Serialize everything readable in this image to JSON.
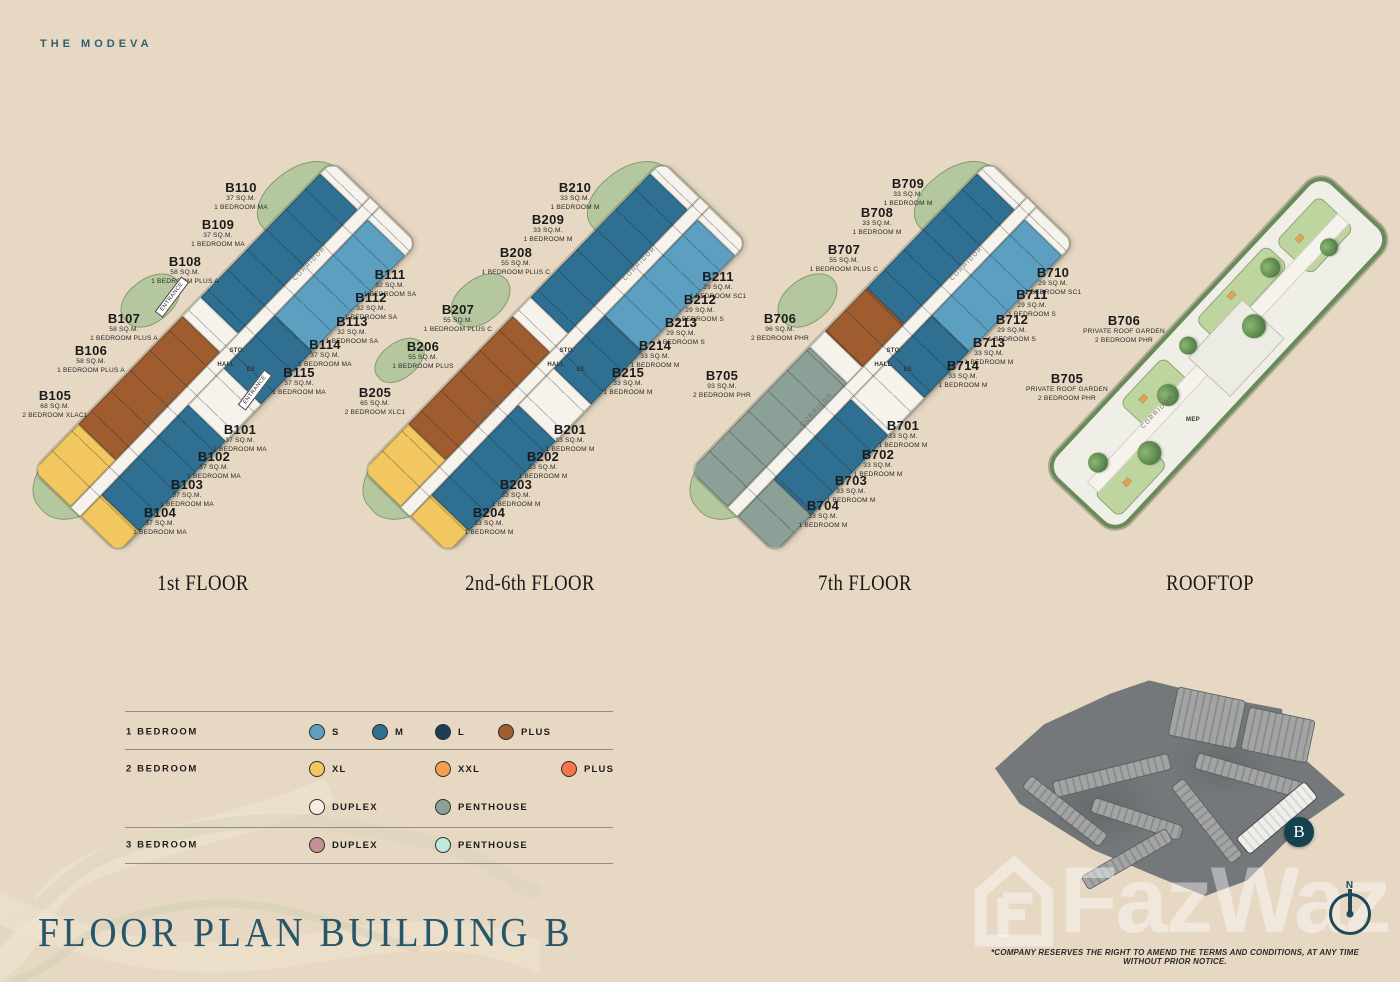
{
  "brand": "THE MODEVA",
  "page_title": "FLOOR PLAN BUILDING B",
  "disclaimer": "*COMPANY RESERVES THE RIGHT TO AMEND THE TERMS AND CONDITIONS, AT ANY TIME WITHOUT PRIOR NOTICE.",
  "watermark": "FazWaz",
  "compass_label": "N",
  "site_map": {
    "building_marker": "B"
  },
  "plan_labels": {
    "hall": "HALL",
    "storage": "STO.",
    "lift": "EE",
    "entrance": "ENTRANCE",
    "corridor": "CORRIDOR",
    "mep": "MEP"
  },
  "colors": {
    "background": "#E6D8C3",
    "accent_teal": "#26566A",
    "bed1_s": "#5D9FC1",
    "bed1_m": "#2F7092",
    "bed1_l": "#1F3D52",
    "bed1_plus": "#9E5C2F",
    "bed2_xl": "#F2C75F",
    "bed2_xxl": "#F2A050",
    "bed2_plus": "#F4764A",
    "bed2_duplex": "#F9EDE3",
    "bed2_penthouse": "#8BA198",
    "bed3_duplex": "#C48F96",
    "bed3_penthouse": "#BFE9DB",
    "landscape_green": "#B5C79E"
  },
  "floors": [
    {
      "name": "1st FLOOR",
      "units": [
        {
          "id": "B110",
          "area": "37 SQ.M.",
          "type": "1 BEDROOM MA"
        },
        {
          "id": "B109",
          "area": "37 SQ.M.",
          "type": "1 BEDROOM MA"
        },
        {
          "id": "B108",
          "area": "58 SQ.M.",
          "type": "1 BEDROOM PLUS A"
        },
        {
          "id": "B107",
          "area": "58 SQ.M.",
          "type": "1 BEDROOM PLUS A"
        },
        {
          "id": "B106",
          "area": "58 SQ.M.",
          "type": "1 BEDROOM PLUS A"
        },
        {
          "id": "B105",
          "area": "68 SQ.M.",
          "type": "2 BEDROOM XLAC1"
        },
        {
          "id": "B111",
          "area": "32 SQ.M.",
          "type": "1 BEDROOM SA"
        },
        {
          "id": "B112",
          "area": "32 SQ.M.",
          "type": "1 BEDROOM SA"
        },
        {
          "id": "B113",
          "area": "32 SQ.M.",
          "type": "1 BEDROOM SA"
        },
        {
          "id": "B114",
          "area": "37 SQ.M.",
          "type": "1 BEDROOM MA"
        },
        {
          "id": "B115",
          "area": "37 SQ.M.",
          "type": "1 BEDROOM MA"
        },
        {
          "id": "B101",
          "area": "37 SQ.M.",
          "type": "1 BEDROOM MA"
        },
        {
          "id": "B102",
          "area": "37 SQ.M.",
          "type": "1 BEDROOM MA"
        },
        {
          "id": "B103",
          "area": "37 SQ.M.",
          "type": "1 BEDROOM MA"
        },
        {
          "id": "B104",
          "area": "37 SQ.M.",
          "type": "1 BEDROOM MA"
        }
      ]
    },
    {
      "name": "2nd-6th FLOOR",
      "units": [
        {
          "id": "B210",
          "area": "33 SQ.M.",
          "type": "1 BEDROOM M"
        },
        {
          "id": "B209",
          "area": "33 SQ.M.",
          "type": "1 BEDROOM M"
        },
        {
          "id": "B208",
          "area": "55 SQ.M.",
          "type": "1 BEDROOM PLUS C"
        },
        {
          "id": "B207",
          "area": "55 SQ.M.",
          "type": "1 BEDROOM PLUS C"
        },
        {
          "id": "B206",
          "area": "55 SQ.M.",
          "type": "1 BEDROOM PLUS"
        },
        {
          "id": "B205",
          "area": "65 SQ.M.",
          "type": "2 BEDROOM XLC1"
        },
        {
          "id": "B211",
          "area": "29 SQ.M.",
          "type": "1 BEDROOM SC1"
        },
        {
          "id": "B212",
          "area": "29 SQ.M.",
          "type": "1 BEDROOM S"
        },
        {
          "id": "B213",
          "area": "29 SQ.M.",
          "type": "1 BEDROOM S"
        },
        {
          "id": "B214",
          "area": "33 SQ.M.",
          "type": "1 BEDROOM M"
        },
        {
          "id": "B215",
          "area": "33 SQ.M.",
          "type": "1 BEDROOM M"
        },
        {
          "id": "B201",
          "area": "33 SQ.M.",
          "type": "1 BEDROOM M"
        },
        {
          "id": "B202",
          "area": "33 SQ.M.",
          "type": "1 BEDROOM M"
        },
        {
          "id": "B203",
          "area": "33 SQ.M.",
          "type": "1 BEDROOM M"
        },
        {
          "id": "B204",
          "area": "33 SQ.M.",
          "type": "1 BEDROOM M"
        }
      ]
    },
    {
      "name": "7th FLOOR",
      "units": [
        {
          "id": "B709",
          "area": "33 SQ.M.",
          "type": "1 BEDROOM M"
        },
        {
          "id": "B708",
          "area": "33 SQ.M.",
          "type": "1 BEDROOM M"
        },
        {
          "id": "B707",
          "area": "55 SQ.M.",
          "type": "1 BEDROOM PLUS C"
        },
        {
          "id": "B706",
          "area": "96 SQ.M.",
          "type": "2 BEDROOM PHR"
        },
        {
          "id": "B705",
          "area": "93 SQ.M.",
          "type": "2 BEDROOM PHR"
        },
        {
          "id": "B710",
          "area": "29 SQ.M.",
          "type": "1 BEDROOM SC1"
        },
        {
          "id": "B711",
          "area": "29 SQ.M.",
          "type": "1 BEDROOM S"
        },
        {
          "id": "B712",
          "area": "29 SQ.M.",
          "type": "1 BEDROOM S"
        },
        {
          "id": "B713",
          "area": "33 SQ.M.",
          "type": "1 BEDROOM M"
        },
        {
          "id": "B714",
          "area": "33 SQ.M.",
          "type": "1 BEDROOM M"
        },
        {
          "id": "B701",
          "area": "33 SQ.M.",
          "type": "1 BEDROOM M"
        },
        {
          "id": "B702",
          "area": "33 SQ.M.",
          "type": "1 BEDROOM M"
        },
        {
          "id": "B703",
          "area": "33 SQ.M.",
          "type": "1 BEDROOM M"
        },
        {
          "id": "B704",
          "area": "33 SQ.M.",
          "type": "1 BEDROOM M"
        }
      ]
    },
    {
      "name": "ROOFTOP",
      "units": [
        {
          "id": "B706",
          "area": "PRIVATE ROOF GARDEN",
          "type": "2 BEDROOM PHR"
        },
        {
          "id": "B705",
          "area": "PRIVATE ROOF GARDEN",
          "type": "2 BEDROOM PHR"
        }
      ]
    }
  ],
  "legend": {
    "rows": [
      {
        "label": "1 BEDROOM",
        "items": [
          {
            "label": "S",
            "color": "#5D9FC1"
          },
          {
            "label": "M",
            "color": "#2F7092"
          },
          {
            "label": "L",
            "color": "#1F3D52"
          },
          {
            "label": "PLUS",
            "color": "#9E5C2F"
          }
        ]
      },
      {
        "label": "2 BEDROOM",
        "items": [
          {
            "label": "XL",
            "color": "#F2C75F"
          },
          {
            "label": "XXL",
            "color": "#F2A050"
          },
          {
            "label": "PLUS",
            "color": "#F4764A"
          }
        ]
      },
      {
        "label": "",
        "items": [
          {
            "label": "DUPLEX",
            "color": "#F9EDE3"
          },
          {
            "label": "PENTHOUSE",
            "color": "#8BA198"
          }
        ]
      },
      {
        "label": "3 BEDROOM",
        "items": [
          {
            "label": "DUPLEX",
            "color": "#C48F96"
          },
          {
            "label": "PENTHOUSE",
            "color": "#BFE9DB"
          }
        ]
      }
    ]
  }
}
